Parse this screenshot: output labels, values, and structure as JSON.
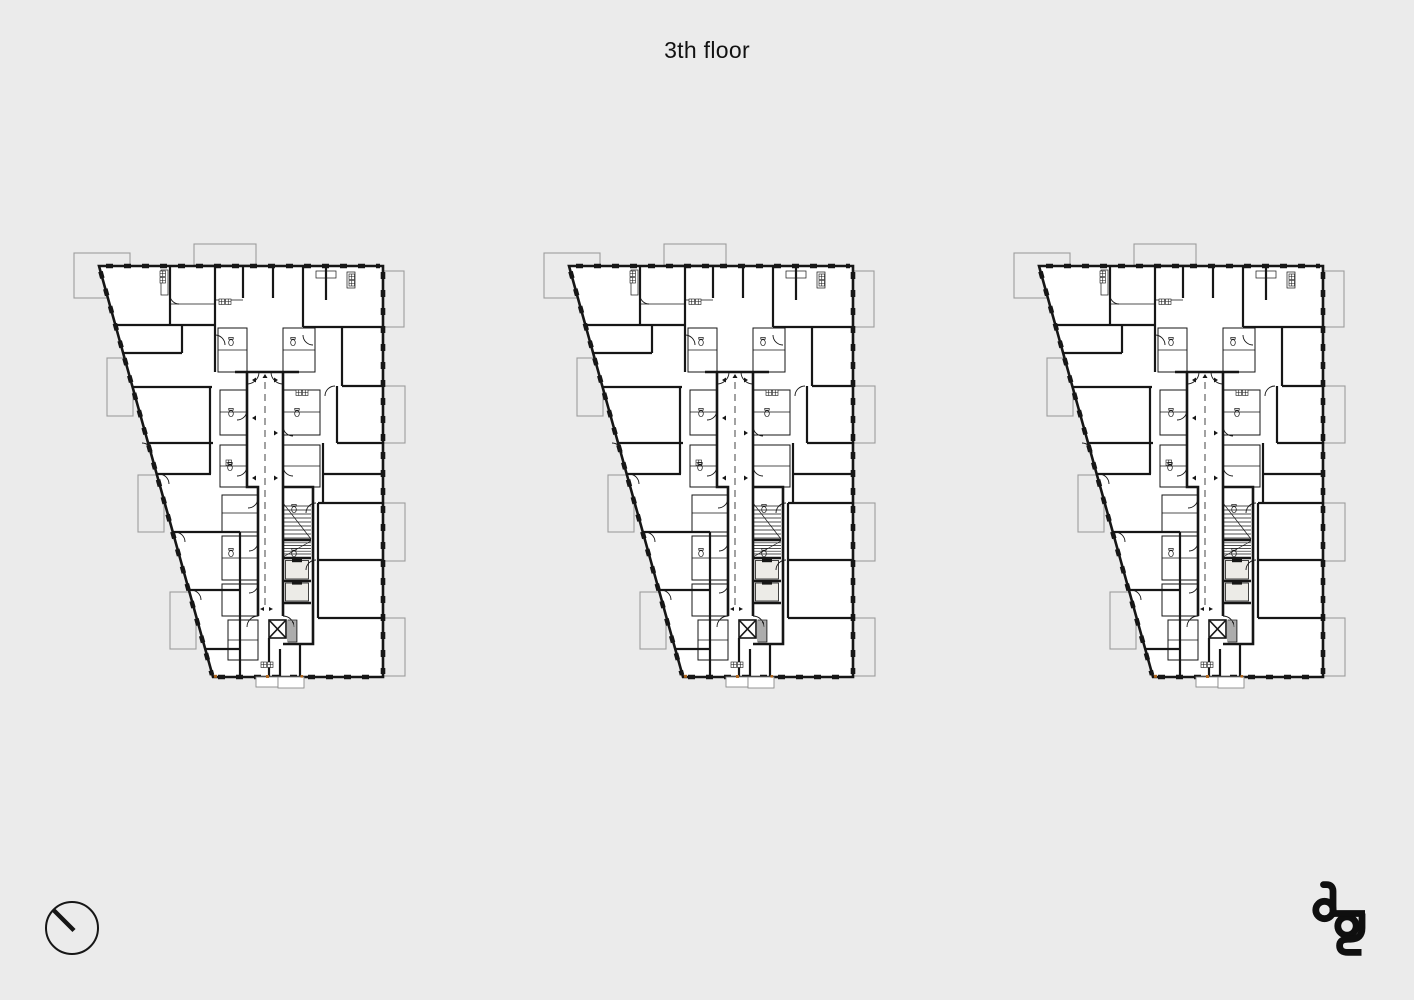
{
  "page": {
    "background_color": "#ebebeb"
  },
  "header": {
    "title": "3th floor"
  },
  "plans": {
    "count": 3,
    "items": [
      {
        "id": "floor-plan-left"
      },
      {
        "id": "floor-plan-center"
      },
      {
        "id": "floor-plan-right"
      }
    ],
    "colors": {
      "wall": "#161616",
      "floor_fill": "#ffffff",
      "balcony_outline": "#9c9c9c",
      "elevator_fill": "#ecebe7",
      "bottom_edge_marker": "#b06820"
    }
  },
  "footer": {
    "north_indicator_icon": "circle-with-needle",
    "logo_monogram": "ag"
  }
}
